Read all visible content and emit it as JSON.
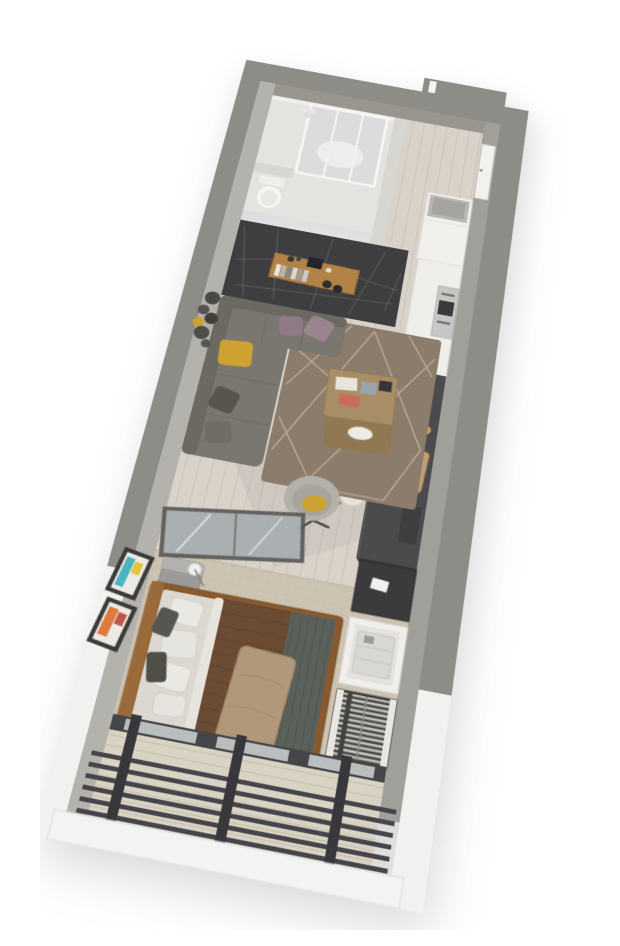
{
  "scene": {
    "label": "3D perspective render of a narrow studio apartment floor plan on a white background",
    "background": "#ffffff"
  },
  "rooms": [
    {
      "name": "bathroom"
    },
    {
      "name": "entry-corridor"
    },
    {
      "name": "kitchen"
    },
    {
      "name": "living-area"
    },
    {
      "name": "sleeping-area"
    },
    {
      "name": "balcony"
    }
  ],
  "furniture": [
    {
      "name": "shower-enclosure"
    },
    {
      "name": "toilet"
    },
    {
      "name": "entry-door"
    },
    {
      "name": "entry-cabinet"
    },
    {
      "name": "wall-console-shelf"
    },
    {
      "name": "books"
    },
    {
      "name": "corner-sofa"
    },
    {
      "name": "throw-pillows"
    },
    {
      "name": "wall-decor-circles"
    },
    {
      "name": "area-rug"
    },
    {
      "name": "coffee-table"
    },
    {
      "name": "armchair"
    },
    {
      "name": "kitchen-counter"
    },
    {
      "name": "cooktop"
    },
    {
      "name": "built-in-oven"
    },
    {
      "name": "bar-stools"
    },
    {
      "name": "mirror-wardrobe"
    },
    {
      "name": "nightstand"
    },
    {
      "name": "table-lamp"
    },
    {
      "name": "double-bed"
    },
    {
      "name": "wall-art"
    },
    {
      "name": "desk"
    },
    {
      "name": "desk-chair"
    },
    {
      "name": "laundry-unit"
    },
    {
      "name": "hanger-rack"
    },
    {
      "name": "louver-railing"
    }
  ],
  "palette": {
    "wall_gray": "#8e8c86",
    "wall_top_light": "#b4b2ac",
    "wall_top_right": "#a19f99",
    "wall_inner": "#98968f",
    "white_exterior": "#f1f1ef",
    "bath_floor": "#e4e3df",
    "partition": "#d7d6d1",
    "accent_wall": "#3e3d3f",
    "accent_lines": "#75736c",
    "console_wood": "#b28347",
    "sofa": "#797770",
    "sofa_dark": "#6b6962",
    "mustard": "#cda232",
    "mauve": "#9b8490",
    "pillow_dark": "#57554f",
    "rug": "#8c7c6c",
    "rug_lines": "#cfc3ae",
    "table_wood": "#a88e66",
    "table_shelf": "#8f7852",
    "chair_shell": "#b3b1aa",
    "counter_white": "#efeeeb",
    "counter_dark": "#4b4a4c",
    "cooktop": "#242327",
    "steel": "#c6c6c4",
    "stool": "#e9e5da",
    "mirror_glass": "#a7adb0",
    "mirror_frame": "#5a5957",
    "nightstand": "#9c9a96",
    "bed_frame": "#8a5a2f",
    "headboard": "#9a6a3a",
    "mattress": "#dcd8d1",
    "duvet": "#6b4c33",
    "blanket": "#5a605a",
    "throw": "#b2987a",
    "pillow_white": "#eae8e3",
    "carpet": "#cbc2b1",
    "desk": "#3b3a3d",
    "unit_white": "#f0efec",
    "rack_dark": "#434240",
    "hanger": "#d9d7d1",
    "window_frame": "#46454a",
    "glass": "#c7cbca",
    "slat": "#45444a",
    "balcony_floor": "#d9d3c4",
    "parapet": "#f3f3f1",
    "door": "#f2f1ee",
    "cabinet": "#f1f0ed",
    "art_teal": "#4ab5c0",
    "art_yellow": "#e3c43c",
    "art_orange": "#e0793e",
    "art_red": "#c2564a",
    "frame_dark": "#3b3a38"
  }
}
